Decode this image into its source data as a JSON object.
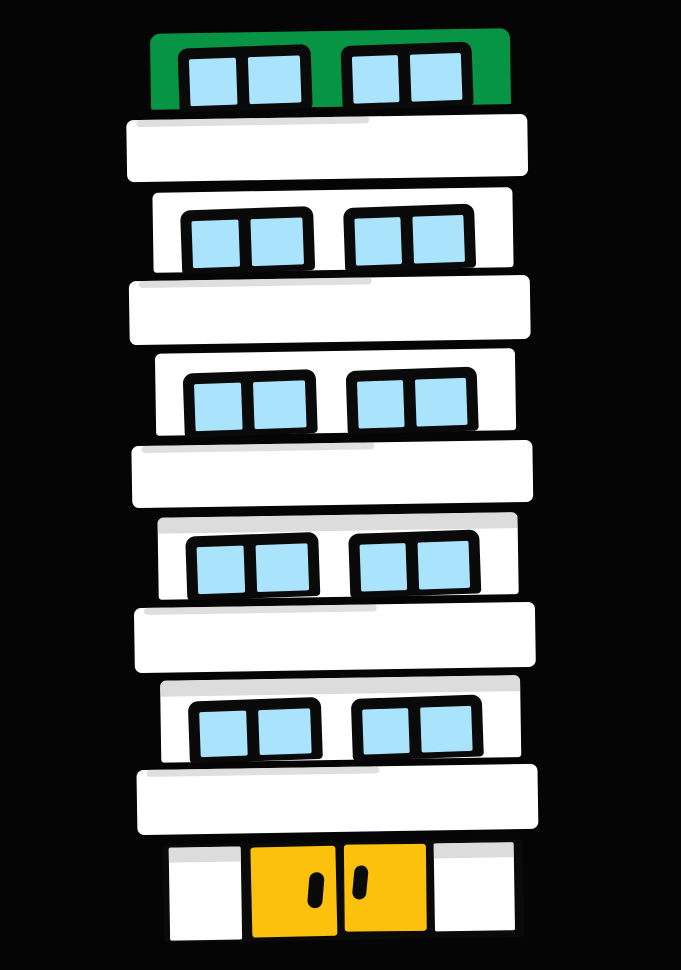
{
  "scene": {
    "type": "cartoon-illustration",
    "subject": "six-story apartment building with rooftop penthouse, balconies and yellow double entrance doors",
    "background": "black"
  },
  "palette": {
    "background": "#050505",
    "outline_black": "#0a0a0a",
    "wall_white": "#ffffff",
    "roof_green": "#089445",
    "window_blue": "#a9e3fc",
    "door_yellow": "#fcc10d",
    "shadow_gray": "#d9d9d9",
    "panel_gray": "#dcdcdc"
  },
  "building": {
    "floor_count": 6,
    "balcony_count": 5,
    "windows_per_floor": 2,
    "panes_per_window": 2,
    "floors": [
      {
        "name": "penthouse",
        "wall": "green",
        "shadow_strip": false
      },
      {
        "name": "floor-5",
        "wall": "white",
        "shadow_strip": false
      },
      {
        "name": "floor-4",
        "wall": "white",
        "shadow_strip": false
      },
      {
        "name": "floor-3",
        "wall": "white",
        "shadow_strip": true
      },
      {
        "name": "floor-2",
        "wall": "white",
        "shadow_strip": true
      }
    ],
    "ground_floor": {
      "door_count": 2,
      "door_color": "yellow",
      "handle_count": 2,
      "side_panel_count": 2
    }
  }
}
